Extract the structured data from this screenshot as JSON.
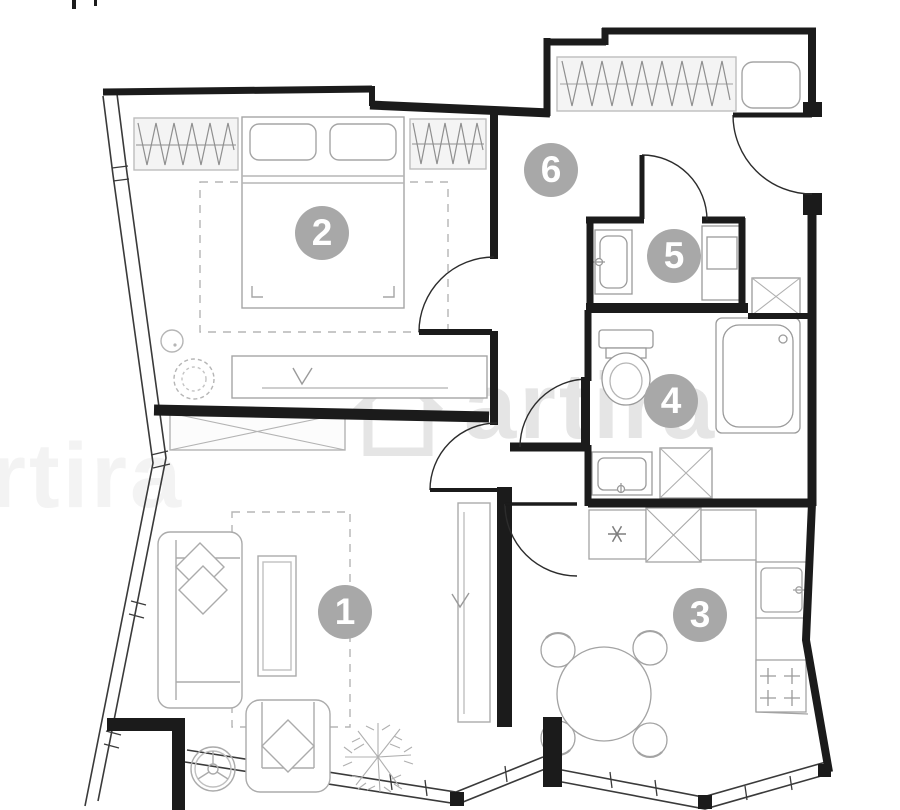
{
  "plan": {
    "watermark": "artira",
    "rooms": [
      {
        "number": "1"
      },
      {
        "number": "2"
      },
      {
        "number": "3"
      },
      {
        "number": "4"
      },
      {
        "number": "5"
      },
      {
        "number": "6"
      }
    ],
    "colors": {
      "wall": "#1b1b1b",
      "furniture_line": "#a5a5a5",
      "hanger_line": "#8f8f8f",
      "window_band": "#3a3a3a",
      "badge_background": "#a8a8a8",
      "badge_text": "#ffffff",
      "watermark_color": "#e5e5e5",
      "background": "#ffffff"
    }
  }
}
